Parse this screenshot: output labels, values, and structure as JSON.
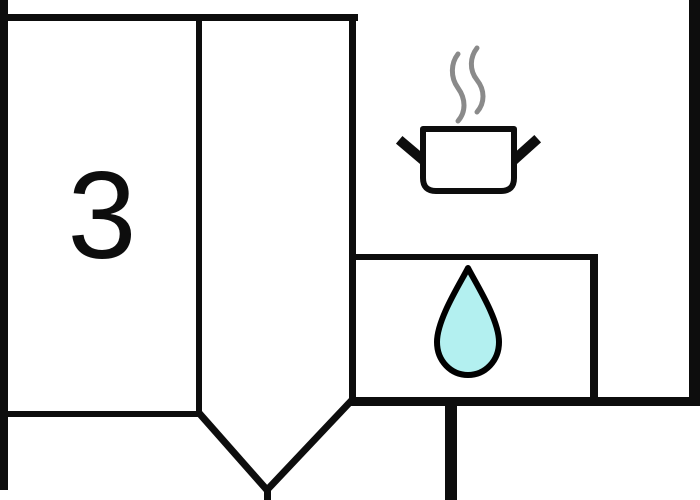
{
  "room": {
    "label": "3"
  },
  "icons": {
    "pot": "cooking-pot-icon",
    "steam": "steam-icon",
    "drop": "water-drop-icon"
  },
  "colors": {
    "wall": "#0d0d0d",
    "background": "#ffffff",
    "steam": "#8a8a8a",
    "drop_fill": "#b3f0f0",
    "drop_stroke": "#000000"
  }
}
